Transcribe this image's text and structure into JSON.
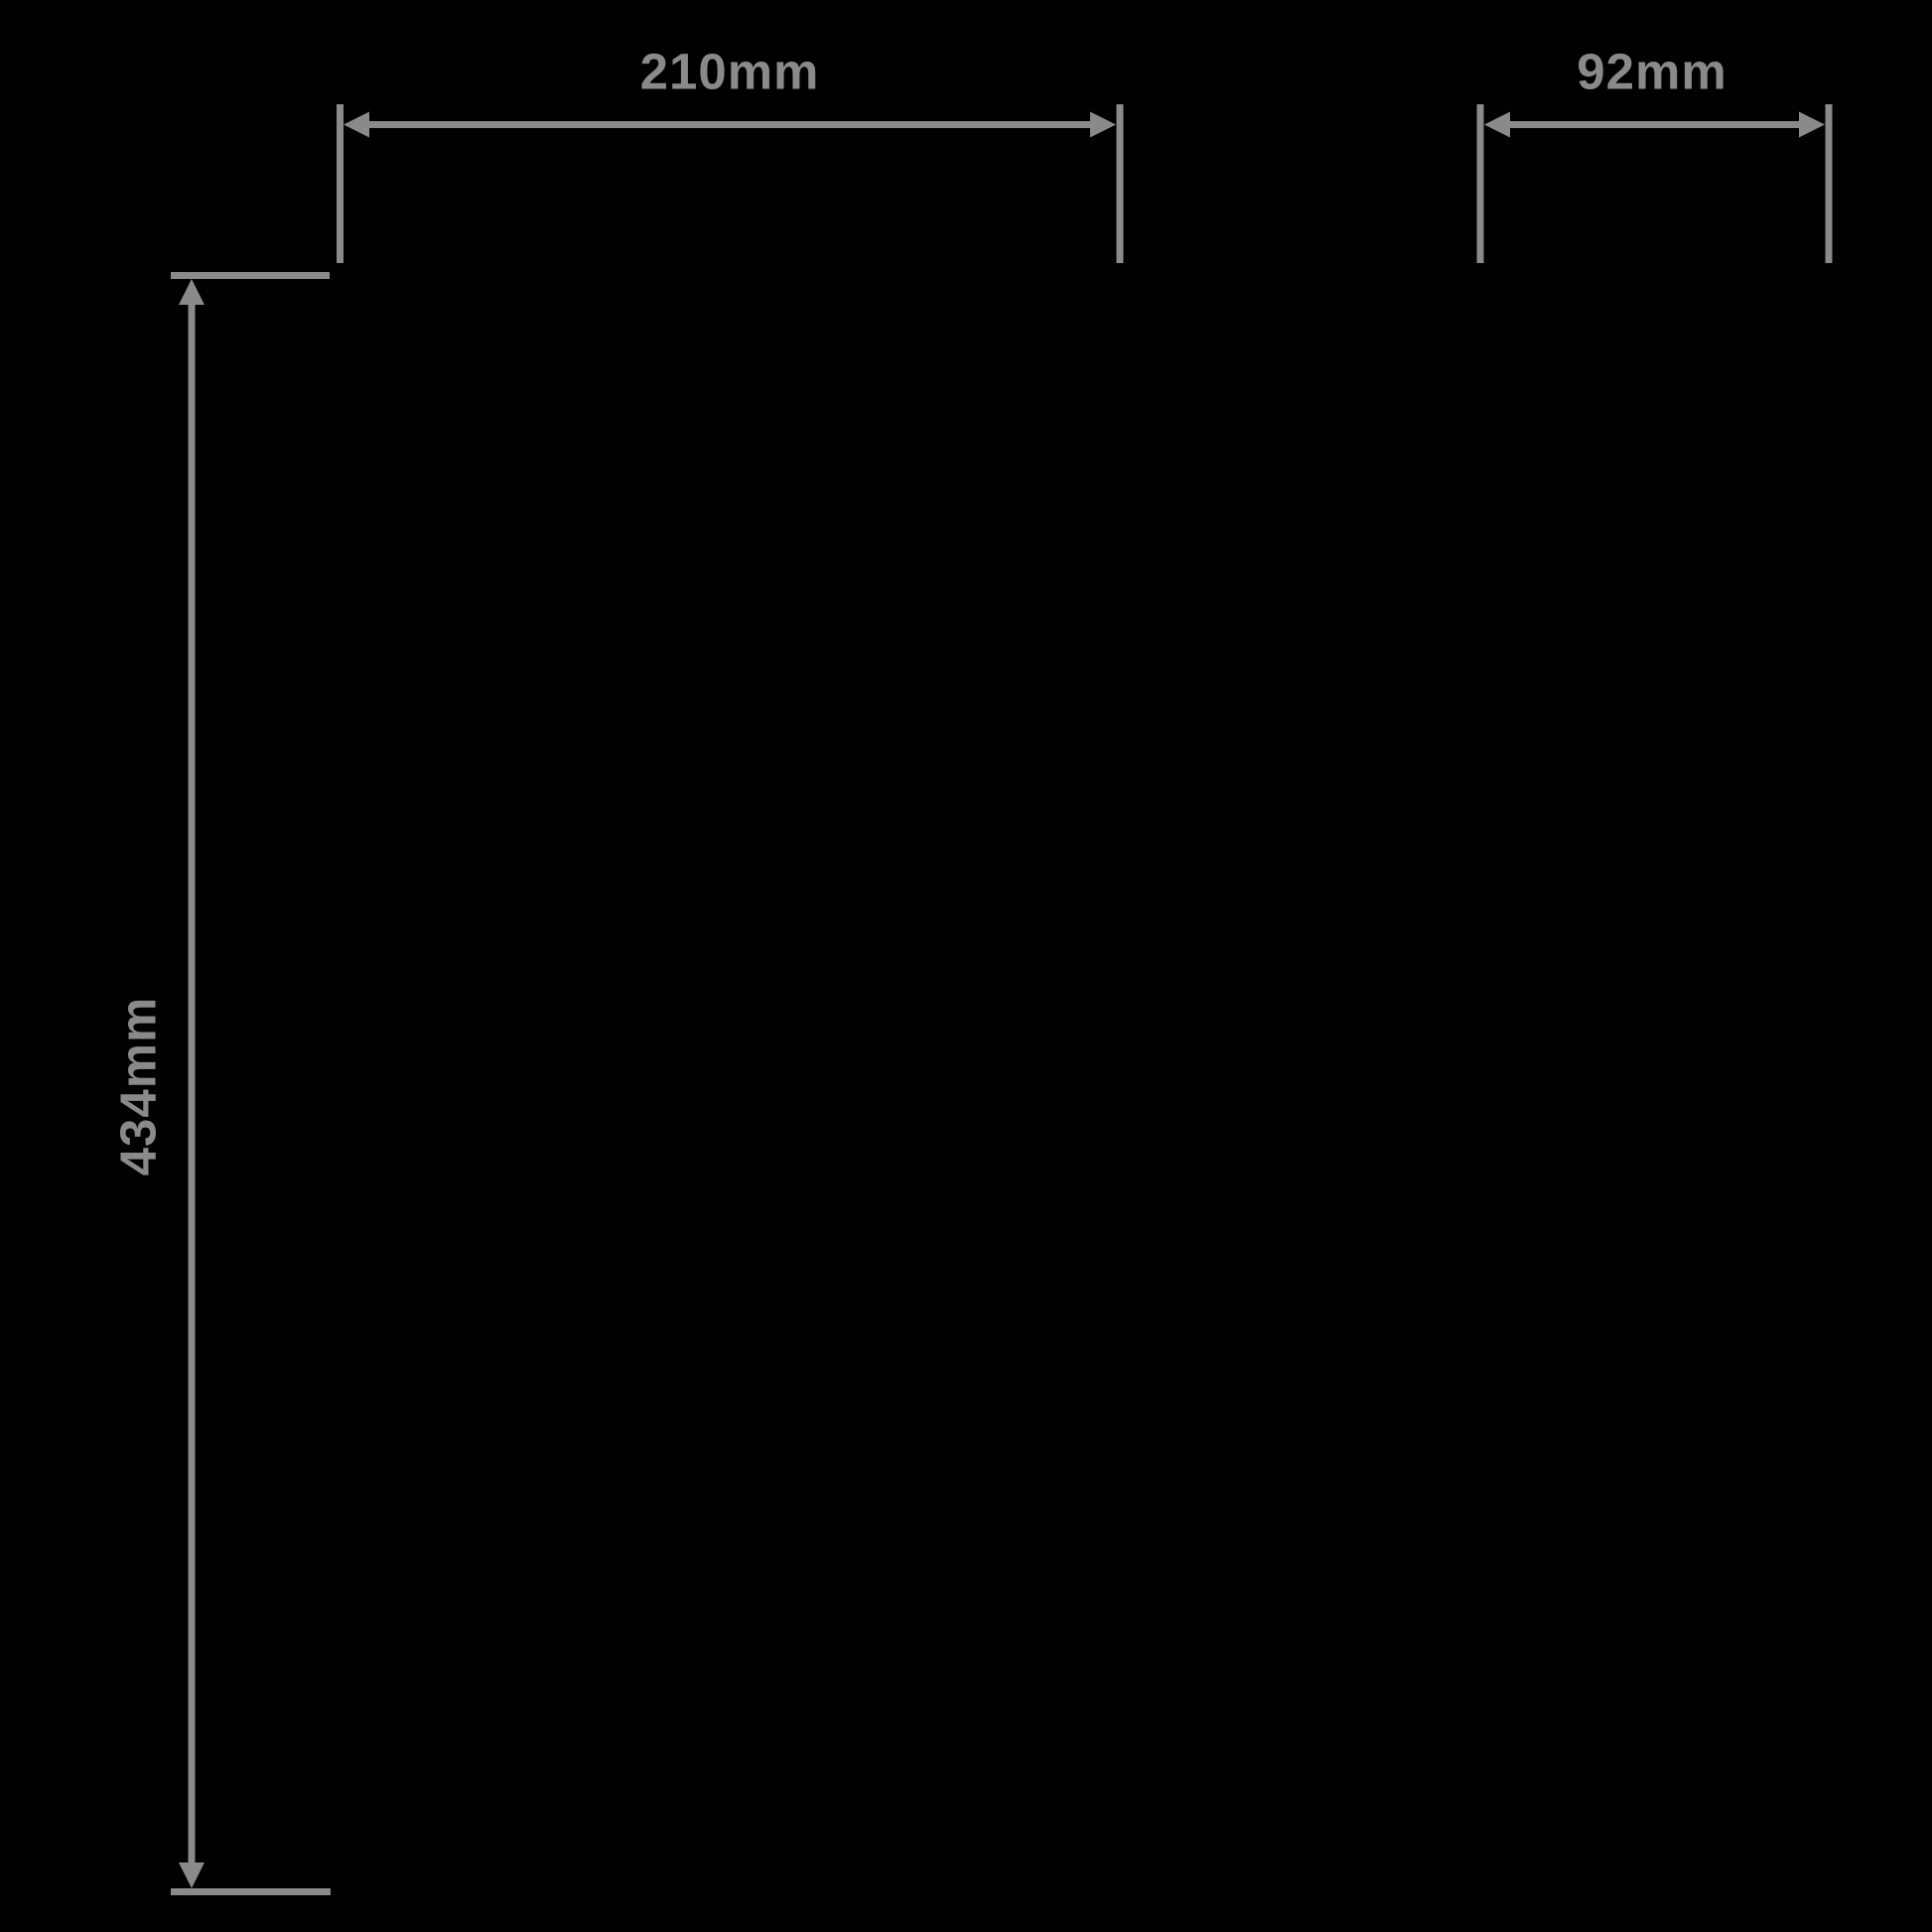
{
  "diagram": {
    "kind": "product-dimension-diagram",
    "background_color": "#000000",
    "annotation_color": "#8a8a8a",
    "width_dimension": {
      "label": "210mm",
      "orientation": "horizontal",
      "position": "top-left"
    },
    "depth_dimension": {
      "label": "92mm",
      "orientation": "horizontal",
      "position": "top-right"
    },
    "height_dimension": {
      "label": "434mm",
      "orientation": "vertical",
      "position": "left"
    }
  }
}
